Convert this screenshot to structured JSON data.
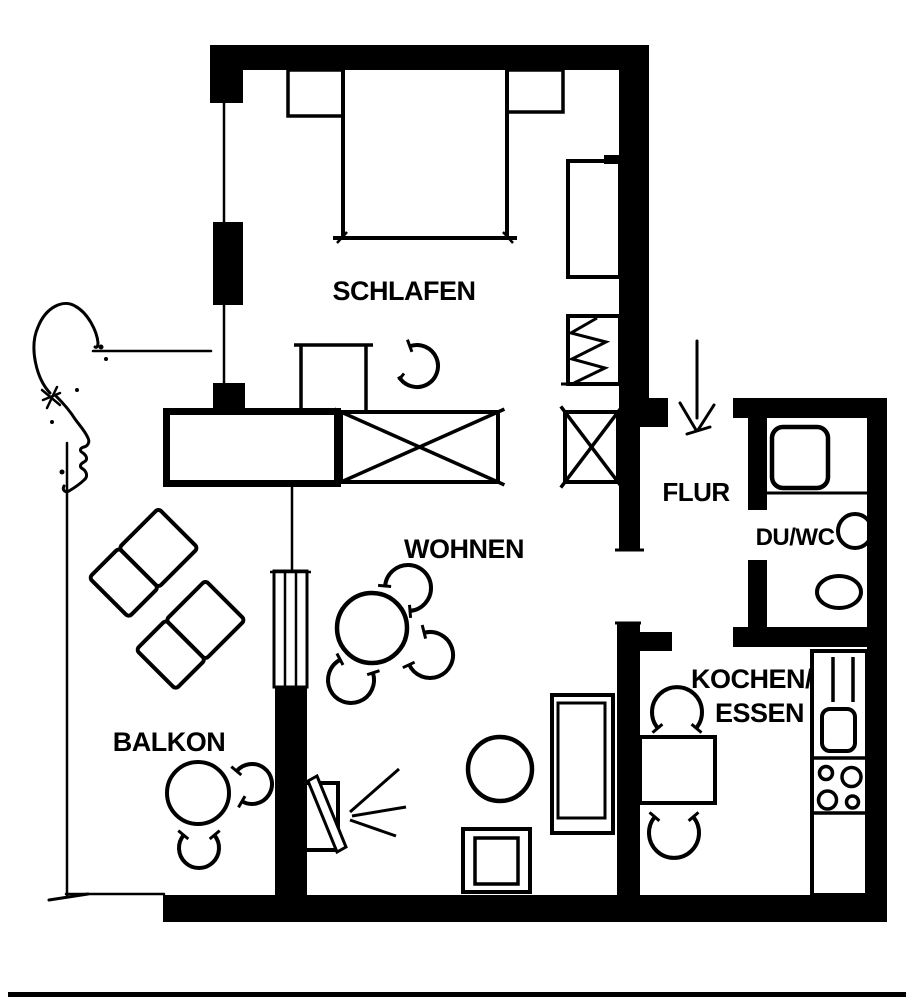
{
  "page": {
    "type": "apartment-floor-plan",
    "language": "de",
    "style": "black-ink scan"
  },
  "colors": {
    "ink": "#000000",
    "paper": "#ffffff"
  },
  "rooms": {
    "schlafen": {
      "label": "SCHLAFEN"
    },
    "wohnen": {
      "label": "WOHNEN"
    },
    "balkon": {
      "label": "BALKON"
    },
    "flur": {
      "label": "FLUR"
    },
    "du_wc": {
      "label": "DU/WC"
    },
    "kochen_essen": {
      "label_line1": "KOCHEN/",
      "label_line2": "ESSEN"
    }
  },
  "symbols": {
    "schlafen": [
      "double-bed",
      "nightstand-left",
      "nightstand-right",
      "tall-cabinet",
      "zigzag-wardrobe",
      "desk",
      "desk-chair",
      "x-wardrobe-large",
      "x-wardrobe-small",
      "sideboard-room-divider",
      "window-front"
    ],
    "wohnen": [
      "dining-table-round",
      "dining-chairs-3",
      "sofa",
      "coffee-table-round",
      "tv-armchair-square",
      "speaker-with-sound-rays",
      "balcony-door"
    ],
    "balkon": [
      "lounger-1",
      "lounger-2",
      "balcony-table-round",
      "balcony-chairs-2",
      "railing",
      "hand-drawn-doodle",
      "dimension-lines"
    ],
    "flur": [
      "entrance-arrow"
    ],
    "du_wc": [
      "shower-tray",
      "washbasin",
      "toilet"
    ],
    "kochen_essen": [
      "kitchen-table",
      "kitchen-chairs-2",
      "kitchen-counter",
      "sink",
      "cooktop-4-burners",
      "tall-unit"
    ]
  }
}
